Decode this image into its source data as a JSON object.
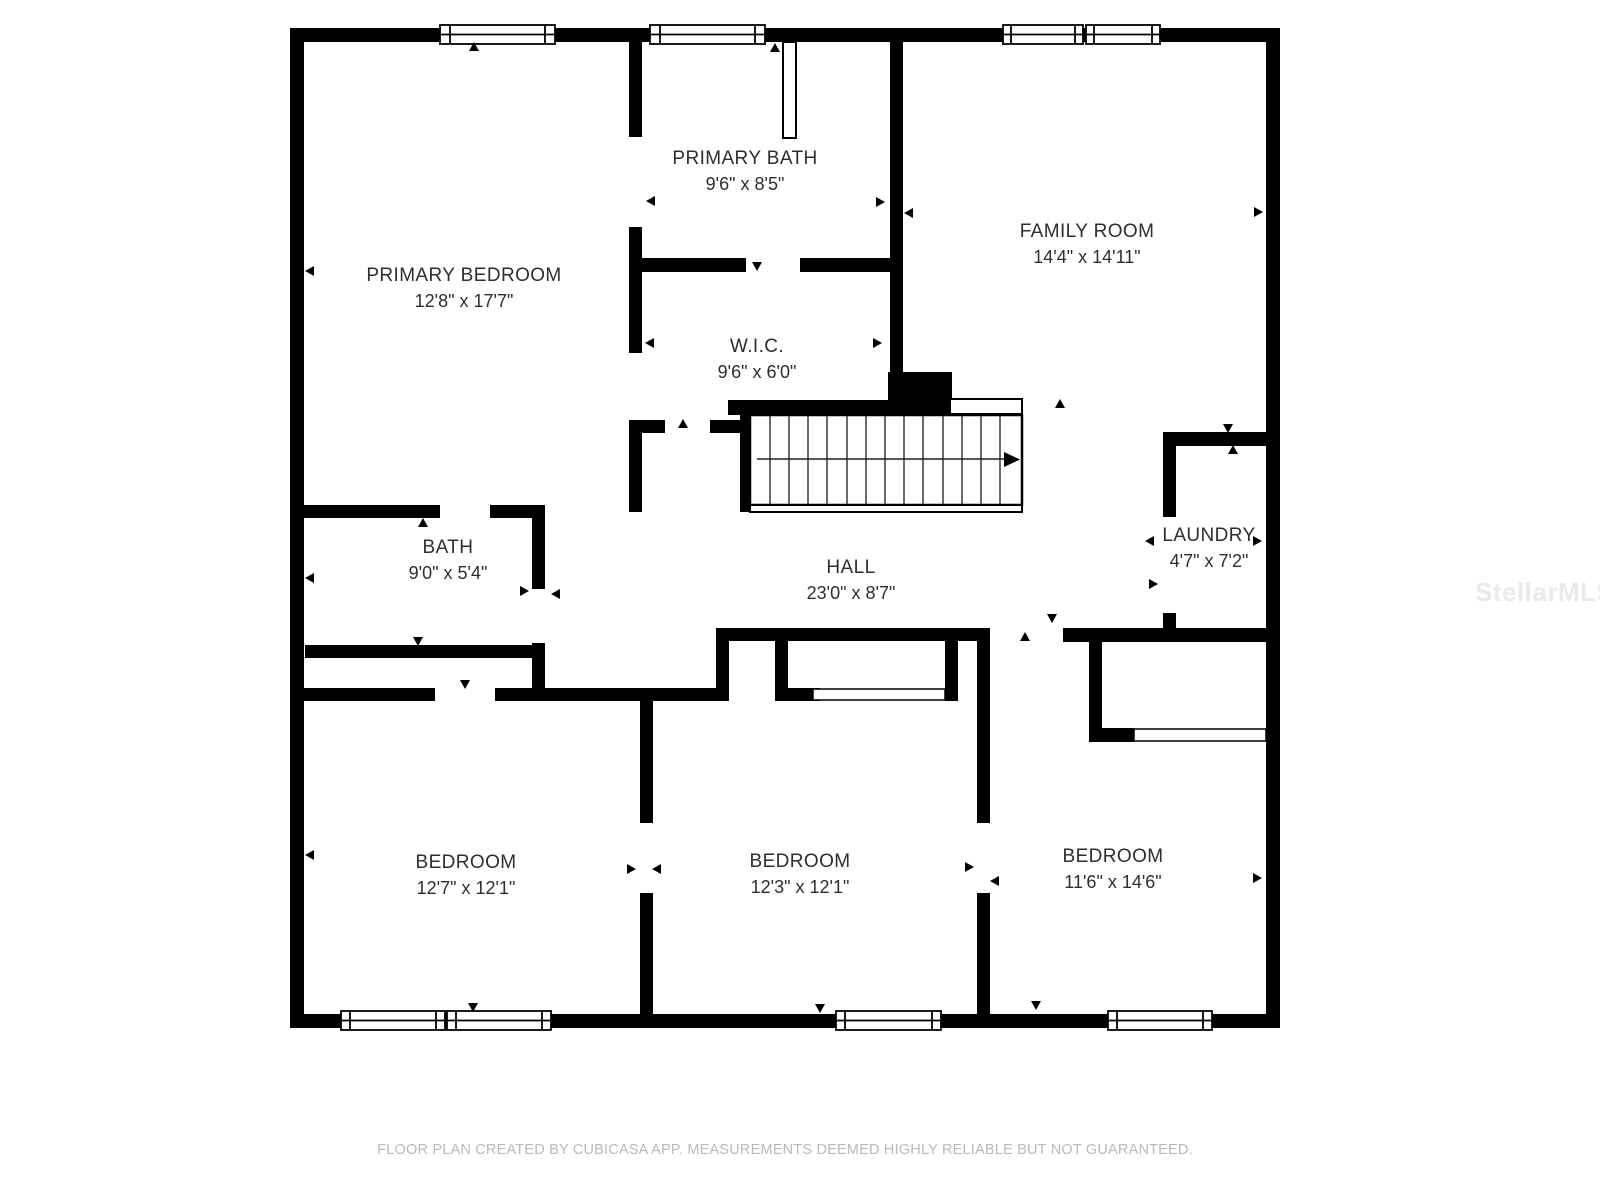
{
  "page": {
    "footer": "FLOOR PLAN CREATED BY CUBICASA APP. MEASUREMENTS DEEMED HIGHLY RELIABLE BUT NOT GUARANTEED.",
    "watermark": "StellarMLS"
  },
  "colors": {
    "wall": "#000000",
    "label_text": "#2e2e2e",
    "footer_text": "#b9b9b9",
    "watermark_text": "#eaeaea",
    "background": "#ffffff"
  },
  "floor_plan": {
    "rooms": [
      {
        "name": "PRIMARY BATH",
        "dimensions": "9'6\" x 8'5\""
      },
      {
        "name": "PRIMARY BEDROOM",
        "dimensions": "12'8\" x 17'7\""
      },
      {
        "name": "FAMILY ROOM",
        "dimensions": "14'4\" x 14'11\""
      },
      {
        "name": "W.I.C.",
        "dimensions": "9'6\" x 6'0\""
      },
      {
        "name": "BATH",
        "dimensions": "9'0\" x 5'4\""
      },
      {
        "name": "HALL",
        "dimensions": "23'0\" x 8'7\""
      },
      {
        "name": "LAUNDRY",
        "dimensions": "4'7\" x 7'2\""
      },
      {
        "name": "BEDROOM",
        "dimensions": "12'7\" x 12'1\""
      },
      {
        "name": "BEDROOM",
        "dimensions": "12'3\" x 12'1\""
      },
      {
        "name": "BEDROOM",
        "dimensions": "11'6\" x 14'6\""
      }
    ]
  }
}
